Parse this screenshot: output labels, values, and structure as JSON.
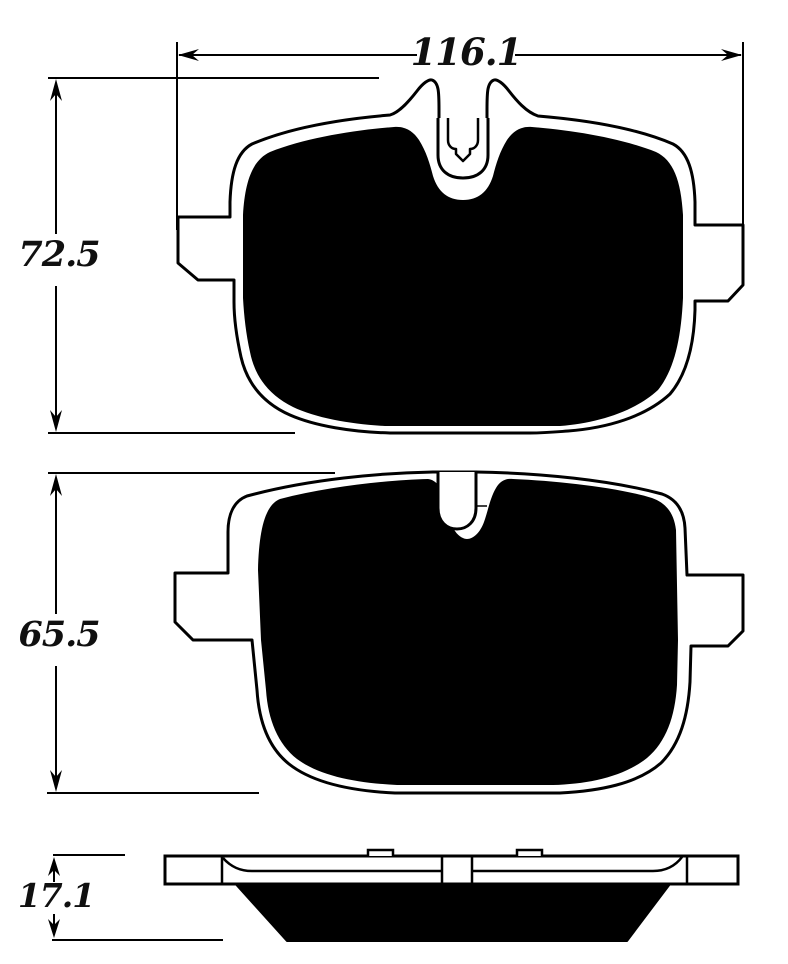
{
  "drawing": {
    "type": "technical-dimension-diagram",
    "subject": "brake pad set: two pad front views and one side profile with dimension callouts",
    "units_implied": "mm",
    "dimensions": {
      "overall_width": "116.1",
      "pad1_height": "72.5",
      "pad2_height": "65.5",
      "thickness": "17.1"
    },
    "colors": {
      "line": "#000000",
      "background": "#ffffff",
      "friction_fill": "#000000",
      "backplate_fill": "#ffffff"
    }
  }
}
